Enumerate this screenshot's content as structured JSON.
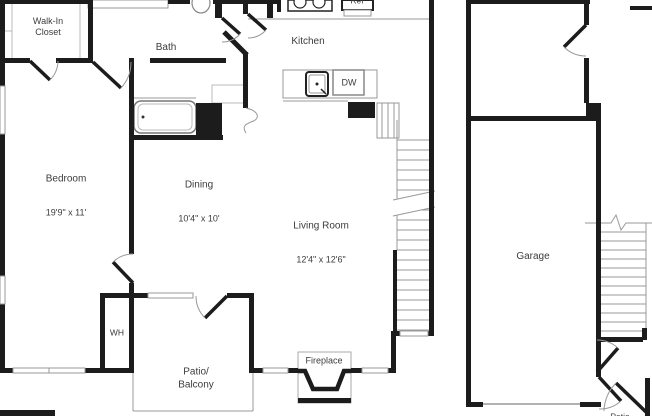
{
  "plan": {
    "rooms": {
      "walk_in_closet": {
        "name": "Walk-In\nCloset"
      },
      "bath": {
        "name": "Bath"
      },
      "kitchen": {
        "name": "Kitchen"
      },
      "bedroom": {
        "name": "Bedroom",
        "dimensions": "19'9\" x 11'"
      },
      "dining": {
        "name": "Dining",
        "dimensions": "10'4\" x 10'"
      },
      "living_room": {
        "name": "Living Room",
        "dimensions": "12'4\" x 12'6\""
      },
      "garage": {
        "name": "Garage"
      },
      "patio_balcony": {
        "name": "Patio/\nBalcony"
      },
      "patio_lower": {
        "name": "Patio"
      }
    },
    "fixtures": {
      "water_heater": "WH",
      "dishwasher": "DW",
      "refrigerator": "Ref",
      "fireplace": "Fireplace"
    },
    "colors": {
      "wall": "#1c1c1c",
      "thin_line": "#999999",
      "text": "#3c3c3c",
      "background": "#ffffff"
    }
  }
}
